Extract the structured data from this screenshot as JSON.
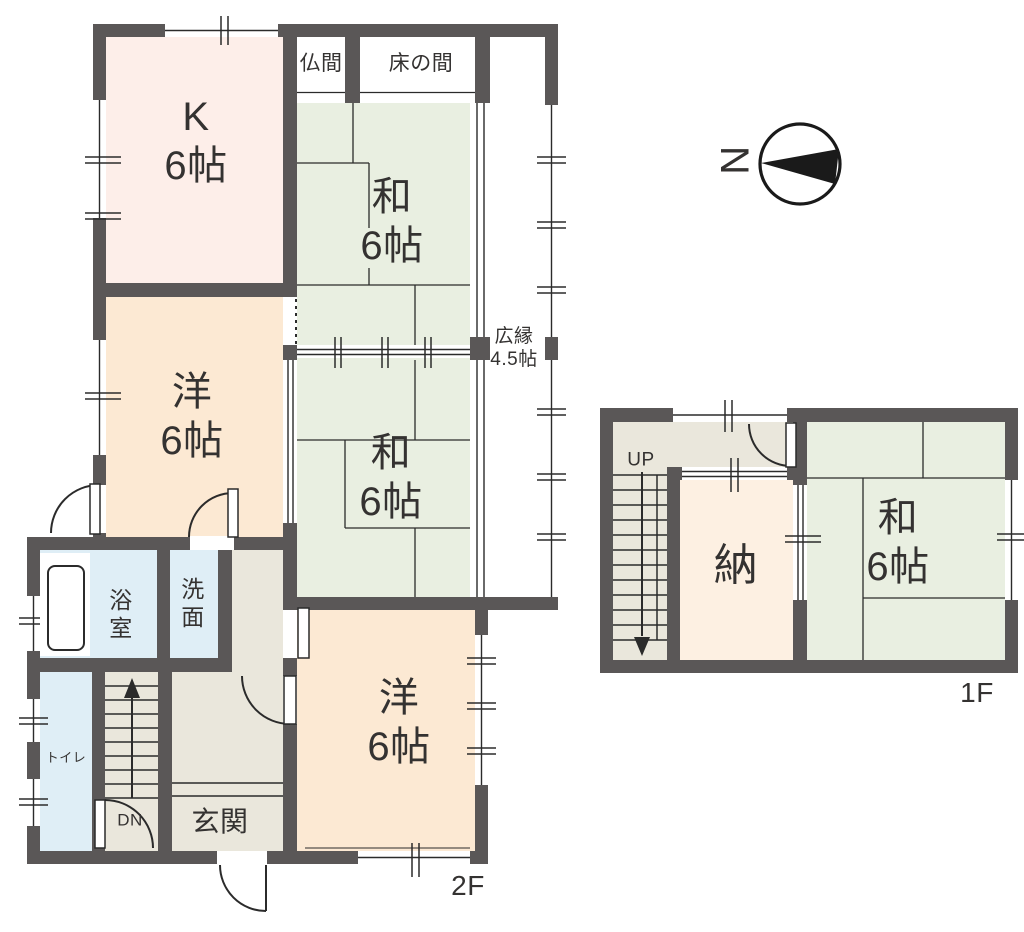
{
  "title": "間取り図 (floor plan)",
  "compass": {
    "letter": "N",
    "direction": "west-pointing"
  },
  "palette": {
    "wall": "#5a5757",
    "line": "#2b2b2b",
    "text": "#343231",
    "kitchen": "#fdeee9",
    "western_room": "#fce9d3",
    "tatami_room": "#e9efe1",
    "wet_room": "#dfeef6",
    "hall": "#eae7dc",
    "storage": "#fdf0e2"
  },
  "floors": [
    {
      "id": "2F",
      "label": "2F",
      "rooms": [
        "K 6帖",
        "和 6帖",
        "和 6帖",
        "洋 6帖",
        "洋 6帖",
        "広縁 4.5帖",
        "仏間",
        "床の間",
        "浴室",
        "洗面",
        "トイレ",
        "玄関",
        "DN"
      ]
    },
    {
      "id": "1F",
      "label": "1F",
      "rooms": [
        "納",
        "和 6帖",
        "UP"
      ]
    }
  ],
  "fills": [
    {
      "name": "room-kitchen",
      "x": 106,
      "y": 37,
      "w": 177,
      "h": 246,
      "color": "#fdeee9"
    },
    {
      "name": "alcove-butsuma",
      "x": 297,
      "y": 37,
      "w": 48,
      "h": 66,
      "color": "#ffffff"
    },
    {
      "name": "alcove-tokonoma",
      "x": 360,
      "y": 37,
      "w": 115,
      "h": 66,
      "color": "#ffffff"
    },
    {
      "name": "room-washitsu-upper",
      "x": 297,
      "y": 103,
      "w": 173,
      "h": 242,
      "color": "#e9efe1"
    },
    {
      "name": "room-washitsu-lower",
      "x": 297,
      "y": 358,
      "w": 173,
      "h": 239,
      "color": "#e9efe1"
    },
    {
      "name": "room-youshitsu-middle",
      "x": 106,
      "y": 297,
      "w": 177,
      "h": 240,
      "color": "#fce9d3"
    },
    {
      "name": "room-youshitsu-lower",
      "x": 297,
      "y": 610,
      "w": 178,
      "h": 241,
      "color": "#fce9d3"
    },
    {
      "name": "room-bath",
      "x": 40,
      "y": 549,
      "w": 117,
      "h": 109,
      "color": "#dfeef6"
    },
    {
      "name": "room-senmen",
      "x": 170,
      "y": 549,
      "w": 48,
      "h": 109,
      "color": "#dfeef6"
    },
    {
      "name": "room-toilet",
      "x": 40,
      "y": 672,
      "w": 52,
      "h": 179,
      "color": "#dfeef6"
    },
    {
      "name": "area-stairs-2f",
      "x": 105,
      "y": 672,
      "w": 53,
      "h": 179,
      "color": "#eae7dc"
    },
    {
      "name": "area-hall-upper",
      "x": 232,
      "y": 549,
      "w": 51,
      "h": 123,
      "color": "#eae7dc"
    },
    {
      "name": "area-hall-genkan",
      "x": 172,
      "y": 672,
      "w": 111,
      "h": 179,
      "color": "#eae7dc"
    },
    {
      "name": "area-stairs-1f",
      "x": 613,
      "y": 422,
      "w": 54,
      "h": 238,
      "color": "#eae7dc"
    },
    {
      "name": "area-corridor-1f",
      "x": 667,
      "y": 422,
      "w": 126,
      "h": 45,
      "color": "#eae7dc"
    },
    {
      "name": "room-nando-1f",
      "x": 680,
      "y": 480,
      "w": 113,
      "h": 180,
      "color": "#fdf0e2"
    },
    {
      "name": "room-washitsu-1f",
      "x": 807,
      "y": 422,
      "w": 198,
      "h": 238,
      "color": "#e9efe1"
    }
  ],
  "labels": [
    {
      "name": "label-kitchen",
      "text": "K\n6帖",
      "x": 196,
      "y": 142,
      "size": 40
    },
    {
      "name": "label-washitsu-upper",
      "text": "和\n6帖",
      "x": 392,
      "y": 222,
      "size": 40
    },
    {
      "name": "label-youshitsu-middle",
      "text": "洋\n6帖",
      "x": 192,
      "y": 417,
      "size": 40
    },
    {
      "name": "label-washitsu-lower",
      "text": "和\n6帖",
      "x": 391,
      "y": 478,
      "size": 40
    },
    {
      "name": "label-youshitsu-lower",
      "text": "洋\n6帖",
      "x": 399,
      "y": 723,
      "size": 40
    },
    {
      "name": "label-hiroen",
      "text": "広縁\n4.5帖",
      "x": 514,
      "y": 348,
      "size": 19
    },
    {
      "name": "label-butsuma",
      "text": "仏間",
      "x": 321,
      "y": 64,
      "size": 21
    },
    {
      "name": "label-tokonoma",
      "text": "床の間",
      "x": 421,
      "y": 64,
      "size": 21
    },
    {
      "name": "label-bath",
      "text": "浴\n室",
      "x": 121,
      "y": 614,
      "size": 23
    },
    {
      "name": "label-senmen",
      "text": "洗\n面",
      "x": 193,
      "y": 603,
      "size": 23
    },
    {
      "name": "label-toilet",
      "text": "トイレ",
      "x": 66,
      "y": 758,
      "size": 13
    },
    {
      "name": "label-dn",
      "text": "DN",
      "x": 130,
      "y": 821,
      "size": 17
    },
    {
      "name": "label-genkan",
      "text": "玄関",
      "x": 220,
      "y": 822,
      "size": 28
    },
    {
      "name": "label-floor-2f",
      "text": "2F",
      "x": 468,
      "y": 886,
      "size": 28
    },
    {
      "name": "label-up",
      "text": "UP",
      "x": 641,
      "y": 460,
      "size": 19
    },
    {
      "name": "label-nando",
      "text": "納",
      "x": 736,
      "y": 566,
      "size": 44
    },
    {
      "name": "label-washitsu-1f",
      "text": "和\n6帖",
      "x": 898,
      "y": 543,
      "size": 40
    },
    {
      "name": "label-floor-1f",
      "text": "1F",
      "x": 977,
      "y": 693,
      "size": 28
    },
    {
      "name": "label-compass-n",
      "text": "N",
      "x": 736,
      "y": 160,
      "size": 40,
      "rotate": -90
    }
  ]
}
